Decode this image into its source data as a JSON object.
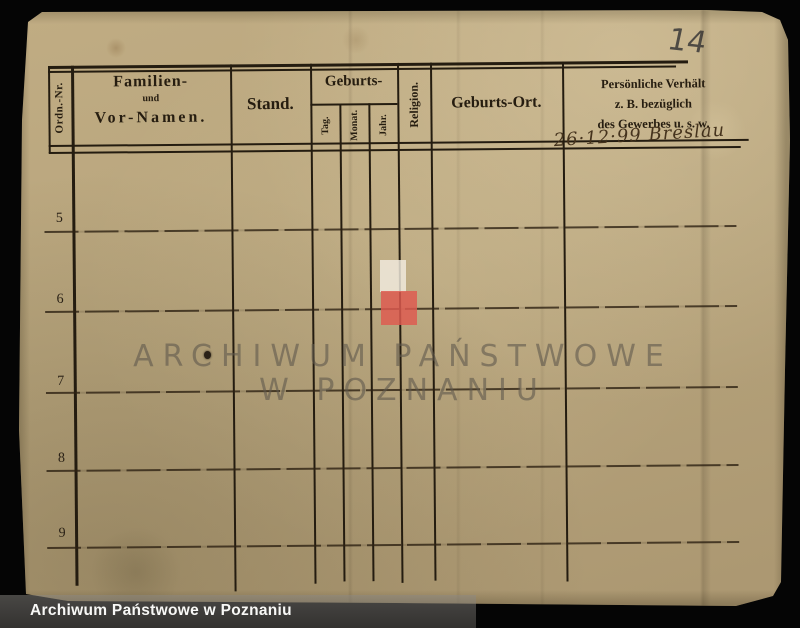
{
  "annotations": {
    "page_number_pencil": "14",
    "entry_handwriting": "26·12·99 Breslau"
  },
  "table": {
    "headers": {
      "ordn_nr": "Ordn.-Nr.",
      "name_line1": "Familien-",
      "name_line2": "und",
      "name_line3": "Vor-Namen.",
      "stand": "Stand.",
      "geburts": "Geburts-",
      "geburts_sub": [
        "Tag.",
        "Monat.",
        "Jahr."
      ],
      "religion": "Religion.",
      "geburts_ort": "Geburts-Ort.",
      "persoenlich_line1": "Persönliche Verhält",
      "persoenlich_line2": "z. B. bezüglich",
      "persoenlich_line3": "des Gewerbes u. s. w."
    },
    "row_numbers": [
      "5",
      "6",
      "7",
      "8",
      "9"
    ]
  },
  "watermark": {
    "line1": "ARCHIWUM PAŃSTWOWE",
    "line2": "W POZNANIU"
  },
  "footer": {
    "label": "Archiwum Państwowe w Poznaniu"
  },
  "colors": {
    "background": "#050505",
    "paper": "#b7a47c",
    "ink": "#241c10",
    "logo_white": "#f2ebdf",
    "logo_red": "#de5a50",
    "handwriting": "#45331d",
    "pencil": "#4e4a44",
    "watermark_text": "#5f584c",
    "footer_text": "#f8f8f6"
  }
}
